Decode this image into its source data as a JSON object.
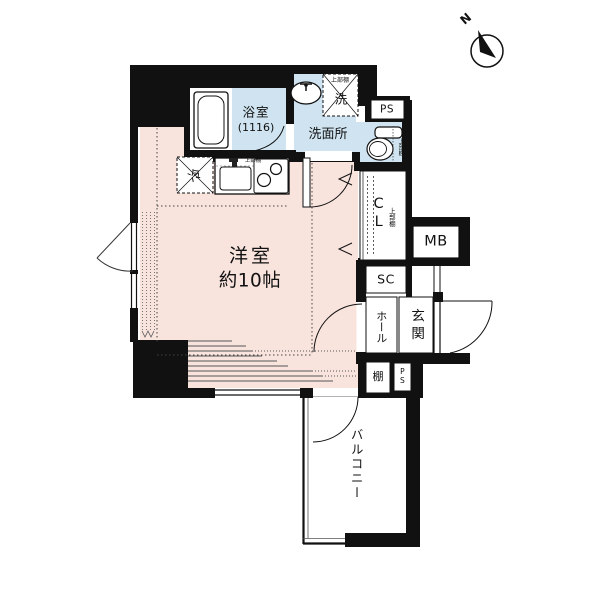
{
  "compass": {
    "north_label": "N"
  },
  "labels": {
    "bath_name": "浴室",
    "bath_size": "(1116)",
    "washroom": "洗面所",
    "laundry": "洗",
    "laundry_shelf": "上部棚",
    "ps_upper": "PS",
    "toilet_shelf": "上部棚",
    "kitchen_shelf": "上部棚",
    "fridge": "冷",
    "main_room_name": "洋室",
    "main_room_size": "約10帖",
    "closet": "CL",
    "closet_shelf": "上部棚",
    "meter_box": "MB",
    "shoe_closet": "SC",
    "hall": "ホール",
    "entrance": "玄関",
    "shelf": "棚",
    "ps_lower": "PS",
    "balcony": "バルコニー"
  },
  "colors": {
    "room_fill": "#f8e3dd",
    "wet_area_fill": "#cfe4f0",
    "wall": "#111111"
  }
}
